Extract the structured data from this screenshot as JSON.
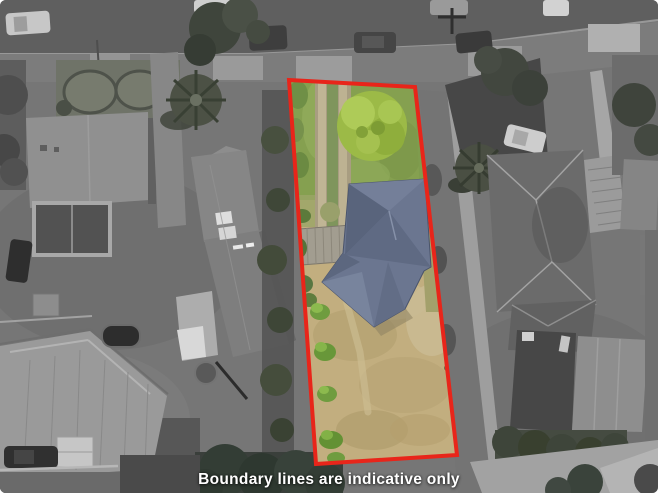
{
  "caption": {
    "text": "Boundary lines are indicative only"
  },
  "boundary": {
    "color": "#e8251a",
    "stroke_width": 4
  },
  "palette": {
    "lawn_green": "#85a050",
    "dry_grass": "#c2ae7f",
    "tree_green": "#9cba47",
    "roof_slate": "#6b7690",
    "caption_text": "#ffffff"
  }
}
